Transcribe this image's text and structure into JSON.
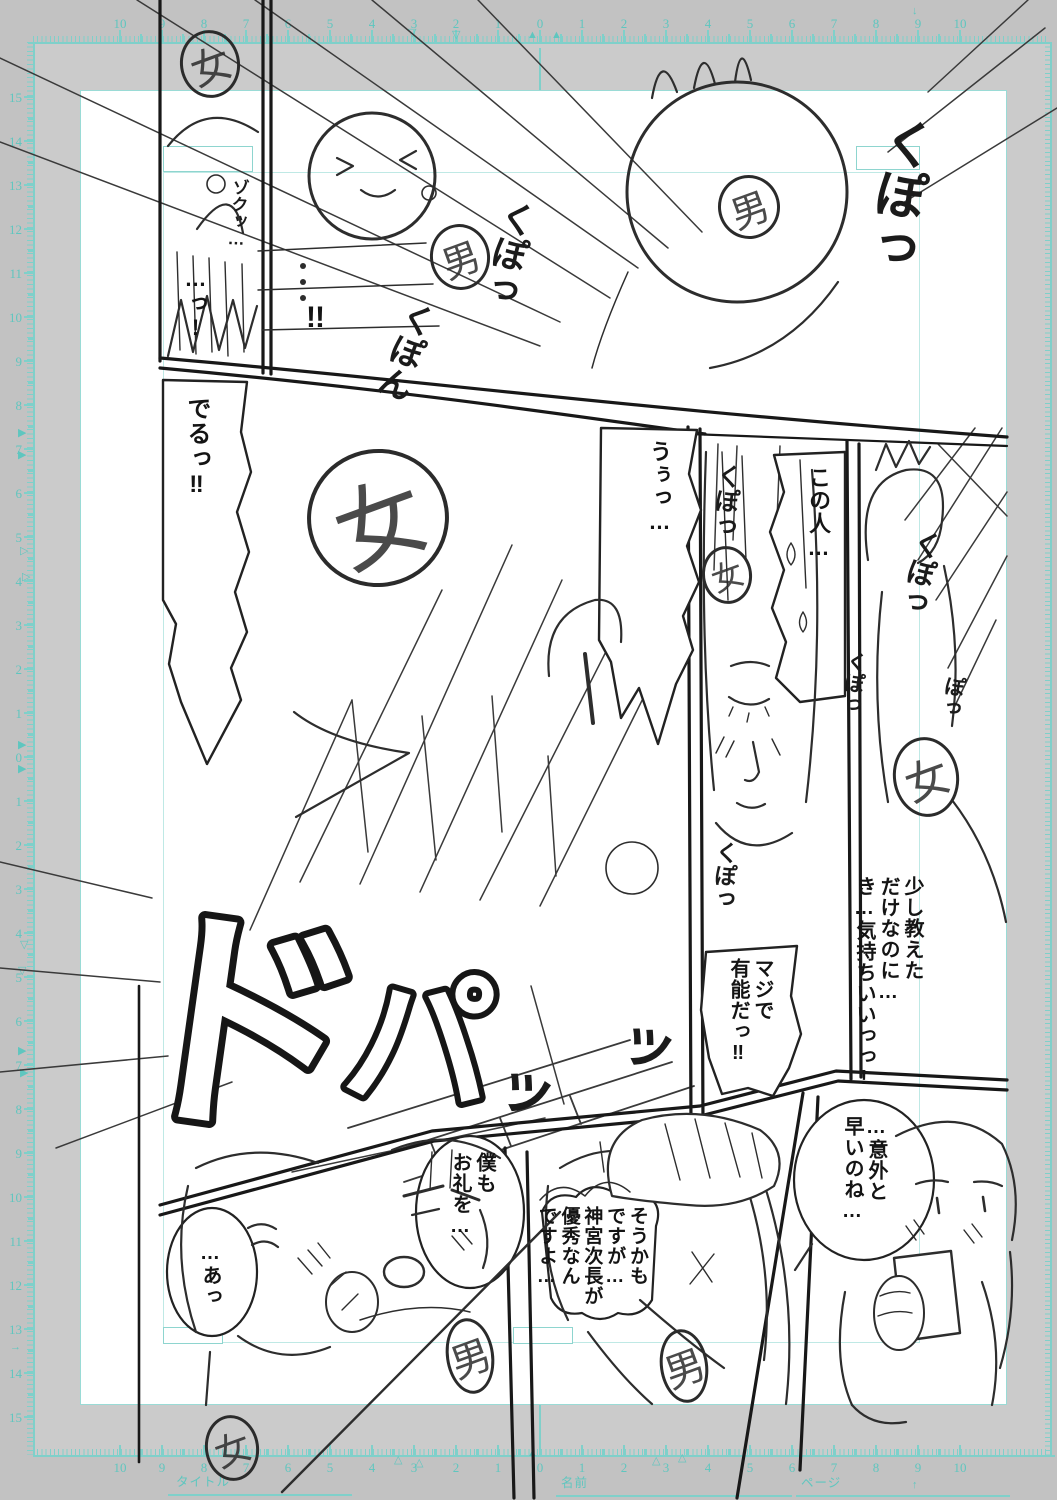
{
  "app": {
    "description": "manga name draft page on digital manuscript paper"
  },
  "palette": {
    "pasteboard": "#cbcbcb",
    "ruler_band": "#c2c2c2",
    "canvas": "#ffffff",
    "guide_cyan": "#7fd0ca",
    "ruler_number_cyan": "#5fc6bf",
    "sketch_ink": "#2c2c2c"
  },
  "rulers": {
    "top": {
      "sequence": [
        "10",
        "9",
        "8",
        "7",
        "6",
        "5",
        "4",
        "3",
        "2",
        "1",
        "0",
        "1",
        "2",
        "3",
        "4",
        "5",
        "6",
        "7",
        "8",
        "9",
        "10"
      ]
    },
    "bottom": {
      "sequence": [
        "10",
        "9",
        "8",
        "7",
        "6",
        "5",
        "4",
        "3",
        "2",
        "1",
        "0",
        "1",
        "2",
        "3",
        "4",
        "5",
        "6",
        "7",
        "8",
        "9",
        "10"
      ]
    },
    "left": {
      "sequence": [
        "15",
        "14",
        "13",
        "12",
        "11",
        "10",
        "9",
        "8",
        "7",
        "6",
        "5",
        "4",
        "3",
        "2",
        "1",
        "0",
        "1",
        "2",
        "3",
        "4",
        "5",
        "6",
        "7",
        "8",
        "9",
        "10",
        "11",
        "12",
        "13",
        "14",
        "15"
      ]
    }
  },
  "footer": {
    "title_label": "タイトル",
    "name_label": "名前",
    "page_label": "ページ"
  },
  "bubbles": [
    {
      "name": "gasp-bubble",
      "text": "…っ!",
      "x": 178,
      "y": 266,
      "w": 30,
      "size": 22
    },
    {
      "name": "bang-bubble",
      "text": "!!",
      "x": 306,
      "y": 300,
      "w": 46,
      "size": 30,
      "horizontal": true
    },
    {
      "name": "deru-bubble",
      "text": "でるっ‼",
      "x": 176,
      "y": 396,
      "w": 34,
      "size": 24
    },
    {
      "name": "uu-bubble",
      "text": "うぅっ…",
      "x": 640,
      "y": 440,
      "w": 32,
      "size": 22
    },
    {
      "name": "konohito-bubble",
      "text": "この人…",
      "x": 799,
      "y": 466,
      "w": 32,
      "size": 22
    },
    {
      "name": "sukoshi-bubble",
      "text": "少し教えた\nだけなのに…\nき…気持ちいいっっ!",
      "x": 846,
      "y": 876,
      "w": 78,
      "size": 20
    },
    {
      "name": "maji-bubble",
      "text": "マジで\n有能だっ‼",
      "x": 718,
      "y": 958,
      "w": 56,
      "size": 20
    },
    {
      "name": "igai-bubble",
      "text": "…意外と\n早いのね…",
      "x": 834,
      "y": 1116,
      "w": 54,
      "size": 20
    },
    {
      "name": "boku-bubble",
      "text": "僕も\nお礼を…",
      "x": 444,
      "y": 1152,
      "w": 52,
      "size": 20
    },
    {
      "name": "soukamo-bubble",
      "text": "そうかも\nですが…\n神宮次長が\n優秀なん\nですよ…",
      "x": 534,
      "y": 1206,
      "w": 114,
      "size": 19
    },
    {
      "name": "a-bubble",
      "text": "…あっ",
      "x": 196,
      "y": 1242,
      "w": 26,
      "size": 20
    }
  ],
  "sfx": [
    {
      "text": "ゾクッ…",
      "x": 230,
      "y": 178,
      "size": 17,
      "rot": 3
    },
    {
      "text": "くぽっ",
      "x": 882,
      "y": 112,
      "size": 52,
      "rot": 10
    },
    {
      "text": "くぽっ",
      "x": 502,
      "y": 196,
      "size": 36,
      "rot": 14
    },
    {
      "text": "くぽん",
      "x": 404,
      "y": 296,
      "size": 34,
      "rot": 20
    },
    {
      "text": "くぽっ",
      "x": 716,
      "y": 462,
      "size": 25,
      "rot": 6
    },
    {
      "text": "くぽっ",
      "x": 714,
      "y": 840,
      "size": 23,
      "rot": 4
    },
    {
      "text": "くぽっ",
      "x": 914,
      "y": 526,
      "size": 29,
      "rot": 14
    },
    {
      "text": "くぽっ",
      "x": 846,
      "y": 650,
      "size": 21,
      "rot": 8
    },
    {
      "text": "ぽっ",
      "x": 944,
      "y": 674,
      "size": 21,
      "rot": 10
    },
    {
      "text": "ッ",
      "x": 492,
      "y": 1050,
      "size": 62,
      "rot": 18
    },
    {
      "text": "ッ",
      "x": 616,
      "y": 1006,
      "size": 60,
      "rot": 18
    }
  ],
  "sfx_outline": [
    {
      "text": "ド",
      "x": 232,
      "y": 1110,
      "size": 240,
      "rot": 8,
      "sw": 14
    },
    {
      "text": "パ",
      "x": 415,
      "y": 1095,
      "size": 150,
      "rot": 4,
      "sw": 12
    }
  ],
  "marks": [
    {
      "ch": "女",
      "x": 210,
      "y": 64,
      "rx": 30,
      "ry": 34,
      "fs": 40
    },
    {
      "ch": "男",
      "x": 460,
      "y": 257,
      "rx": 30,
      "ry": 33,
      "fs": 38
    },
    {
      "ch": "男",
      "x": 749,
      "y": 207,
      "rx": 31,
      "ry": 32,
      "fs": 38
    },
    {
      "ch": "女",
      "x": 378,
      "y": 518,
      "rx": 71,
      "ry": 69,
      "fs": 90,
      "bw": 4
    },
    {
      "ch": "女",
      "x": 727,
      "y": 575,
      "rx": 25,
      "ry": 29,
      "fs": 32
    },
    {
      "ch": "女",
      "x": 926,
      "y": 777,
      "rx": 33,
      "ry": 40,
      "fs": 44
    },
    {
      "ch": "女",
      "x": 232,
      "y": 1448,
      "rx": 27,
      "ry": 33,
      "fs": 36
    },
    {
      "ch": "男",
      "x": 470,
      "y": 1356,
      "rx": 24,
      "ry": 38,
      "fs": 40
    },
    {
      "ch": "男",
      "x": 684,
      "y": 1366,
      "rx": 24,
      "ry": 37,
      "fs": 40
    }
  ],
  "markers": [
    {
      "g": "▽",
      "x": 408,
      "y": 28
    },
    {
      "g": "▽",
      "x": 452,
      "y": 30
    },
    {
      "g": "▲",
      "x": 527,
      "y": 30
    },
    {
      "g": "▲",
      "x": 551,
      "y": 30
    },
    {
      "g": "↓",
      "x": 912,
      "y": 6
    },
    {
      "g": "△",
      "x": 394,
      "y": 1455
    },
    {
      "g": "△",
      "x": 415,
      "y": 1458
    },
    {
      "g": "△",
      "x": 652,
      "y": 1456
    },
    {
      "g": "△",
      "x": 678,
      "y": 1453
    },
    {
      "g": "↑",
      "x": 912,
      "y": 1480
    },
    {
      "g": "▲",
      "x": 527,
      "y": 1448
    },
    {
      "g": "▶",
      "x": 18,
      "y": 428
    },
    {
      "g": "▶",
      "x": 18,
      "y": 450
    },
    {
      "g": "▷",
      "x": 20,
      "y": 546
    },
    {
      "g": "▷",
      "x": 22,
      "y": 572
    },
    {
      "g": "▶",
      "x": 18,
      "y": 740
    },
    {
      "g": "▶",
      "x": 18,
      "y": 764
    },
    {
      "g": "▽",
      "x": 20,
      "y": 940
    },
    {
      "g": "▽",
      "x": 18,
      "y": 966
    },
    {
      "g": "▶",
      "x": 18,
      "y": 1046
    },
    {
      "g": "▶",
      "x": 20,
      "y": 1068
    },
    {
      "g": "→",
      "x": 10,
      "y": 1342
    }
  ]
}
